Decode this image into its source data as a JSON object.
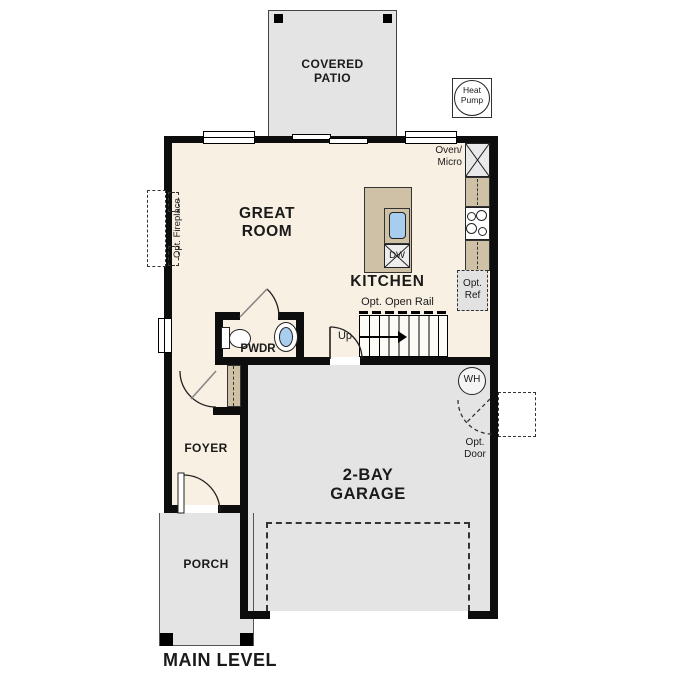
{
  "title": "MAIN LEVEL",
  "rooms": {
    "covered_patio": "COVERED\nPATIO",
    "great_room": "GREAT\nROOM",
    "kitchen": "KITCHEN",
    "pwdr": "PWDR",
    "foyer": "FOYER",
    "garage": "2-BAY\nGARAGE",
    "porch": "PORCH"
  },
  "labels": {
    "heat_pump": "Heat\nPump",
    "oven_micro": "Oven/\nMicro",
    "opt_ref": "Opt.\nRef",
    "opt_open_rail": "Opt. Open Rail",
    "up": "Up",
    "dw": "DW",
    "wh": "WH",
    "opt_door": "Opt.\nDoor",
    "opt_fireplace": "Opt. Fireplace",
    "main_level": "MAIN LEVEL"
  },
  "colors": {
    "floor": "#f8f0e2",
    "counter": "#cfc1a6",
    "concrete": "#e4e4e4",
    "sink": "#a9cdee",
    "wall": "#0d0d0d"
  }
}
